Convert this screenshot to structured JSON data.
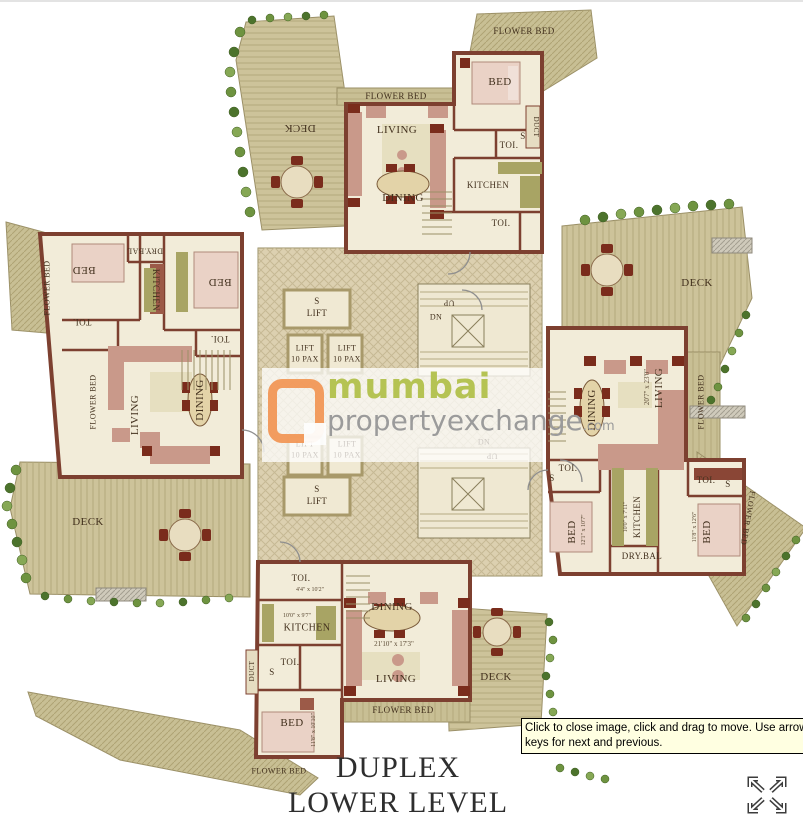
{
  "viewer": {
    "tooltip": "Click to close image, click and drag to move. Use arrow keys for next and previous.",
    "icons": {
      "move_icon": "expand-move-arrows",
      "logo_icon": "mumbai-propertyexchange-square"
    }
  },
  "title": {
    "line1": "DUPLEX",
    "line2": "LOWER LEVEL"
  },
  "watermark": {
    "brand": "mumbai",
    "brand2": "propertyexchange",
    "tld": ".com"
  },
  "colors": {
    "wall": "#7d4030",
    "floor": "#f2ecd9",
    "deck": "#cdc39a",
    "lobby": "#dcd0b0",
    "furniture": "#c9998a",
    "accent_dark": "#7a2c1c",
    "plants": "#6e9340",
    "watermark_orange": "#f29350",
    "watermark_green": "#b5c353",
    "watermark_gray": "#9b9b9b",
    "tooltip_bg": "#ffffe1"
  },
  "plan": {
    "labels": [
      {
        "t": "DECK",
        "x": 300,
        "y": 128,
        "r": 180,
        "s": 11
      },
      {
        "t": "FLOWER BED",
        "x": 524,
        "y": 31,
        "s": 9
      },
      {
        "t": "BED",
        "x": 500,
        "y": 82,
        "s": 11
      },
      {
        "t": "FLOWER BED",
        "x": 396,
        "y": 96,
        "s": 9
      },
      {
        "t": "LIVING",
        "x": 397,
        "y": 130,
        "s": 11
      },
      {
        "t": "TOI.",
        "x": 509,
        "y": 145,
        "s": 9
      },
      {
        "t": "S",
        "x": 523,
        "y": 136,
        "s": 9
      },
      {
        "t": "DUCT",
        "x": 536,
        "y": 127,
        "r": 90,
        "s": 7
      },
      {
        "t": "DINING",
        "x": 403,
        "y": 198,
        "s": 11
      },
      {
        "t": "KITCHEN",
        "x": 488,
        "y": 185,
        "s": 9
      },
      {
        "t": "TOI.",
        "x": 501,
        "y": 223,
        "s": 9
      },
      {
        "t": "FLOWER BED",
        "x": 47,
        "y": 288,
        "r": -90,
        "s": 8
      },
      {
        "t": "BED",
        "x": 84,
        "y": 270,
        "r": 180,
        "s": 11
      },
      {
        "t": "DRY.BAL",
        "x": 145,
        "y": 251,
        "r": 180,
        "s": 8
      },
      {
        "t": "KITCHEN",
        "x": 156,
        "y": 290,
        "r": 90,
        "s": 9
      },
      {
        "t": "BED",
        "x": 220,
        "y": 282,
        "r": 180,
        "s": 11
      },
      {
        "t": "TOI.",
        "x": 82,
        "y": 322,
        "r": 180,
        "s": 9
      },
      {
        "t": "TOI.",
        "x": 220,
        "y": 339,
        "r": 180,
        "s": 9
      },
      {
        "t": "FLOWER BED",
        "x": 93,
        "y": 402,
        "r": -90,
        "s": 8
      },
      {
        "t": "LIVING",
        "x": 135,
        "y": 415,
        "r": -90,
        "s": 11
      },
      {
        "t": "DINING",
        "x": 200,
        "y": 400,
        "r": -90,
        "s": 11
      },
      {
        "t": "DECK",
        "x": 88,
        "y": 522,
        "s": 11
      },
      {
        "t": "S",
        "x": 317,
        "y": 301,
        "s": 9
      },
      {
        "t": "LIFT",
        "x": 317,
        "y": 313,
        "s": 9
      },
      {
        "t": "LIFT",
        "x": 305,
        "y": 348,
        "s": 8
      },
      {
        "t": "10 PAX",
        "x": 305,
        "y": 359,
        "s": 8
      },
      {
        "t": "LIFT",
        "x": 347,
        "y": 348,
        "s": 8
      },
      {
        "t": "10 PAX",
        "x": 347,
        "y": 359,
        "s": 8
      },
      {
        "t": "DN",
        "x": 436,
        "y": 317,
        "s": 8
      },
      {
        "t": "UP",
        "x": 449,
        "y": 303,
        "r": 180,
        "s": 8
      },
      {
        "t": "LIFT",
        "x": 305,
        "y": 444,
        "s": 8
      },
      {
        "t": "10 PAX",
        "x": 305,
        "y": 455,
        "s": 8
      },
      {
        "t": "LIFT",
        "x": 347,
        "y": 444,
        "s": 8
      },
      {
        "t": "10 PAX",
        "x": 347,
        "y": 455,
        "s": 8
      },
      {
        "t": "DN",
        "x": 484,
        "y": 442,
        "s": 8
      },
      {
        "t": "UP",
        "x": 492,
        "y": 456,
        "r": 180,
        "s": 8
      },
      {
        "t": "S",
        "x": 317,
        "y": 489,
        "s": 9
      },
      {
        "t": "LIFT",
        "x": 317,
        "y": 501,
        "s": 9
      },
      {
        "t": "DECK",
        "x": 697,
        "y": 283,
        "s": 11
      },
      {
        "t": "DINING",
        "x": 592,
        "y": 410,
        "r": -90,
        "s": 11
      },
      {
        "t": "20'7\" x 23'0\"",
        "x": 647,
        "y": 387,
        "r": -90,
        "s": 7,
        "dim": true
      },
      {
        "t": "LIVING",
        "x": 659,
        "y": 388,
        "r": -90,
        "s": 11
      },
      {
        "t": "FLOWER BED",
        "x": 701,
        "y": 402,
        "r": -90,
        "s": 8
      },
      {
        "t": "TOI.",
        "x": 568,
        "y": 468,
        "s": 9
      },
      {
        "t": "S",
        "x": 552,
        "y": 478,
        "s": 9
      },
      {
        "t": "TOI.",
        "x": 706,
        "y": 480,
        "s": 9
      },
      {
        "t": "S",
        "x": 728,
        "y": 484,
        "s": 9
      },
      {
        "t": "10'0\" x 7'11\"",
        "x": 626,
        "y": 517,
        "r": -90,
        "s": 6,
        "dim": true
      },
      {
        "t": "KITCHEN",
        "x": 637,
        "y": 517,
        "r": -90,
        "s": 9
      },
      {
        "t": "DRY.BAL",
        "x": 642,
        "y": 556,
        "s": 9
      },
      {
        "t": "12'1\" x 10'7\"",
        "x": 584,
        "y": 530,
        "r": -90,
        "s": 6,
        "dim": true
      },
      {
        "t": "BED",
        "x": 572,
        "y": 532,
        "r": -90,
        "s": 11
      },
      {
        "t": "11'8\" x 12'6\"",
        "x": 695,
        "y": 527,
        "r": -90,
        "s": 6,
        "dim": true
      },
      {
        "t": "BED",
        "x": 707,
        "y": 532,
        "r": -90,
        "s": 11
      },
      {
        "t": "FLOWER BED",
        "x": 748,
        "y": 518,
        "r": 100,
        "s": 8
      },
      {
        "t": "TOI.",
        "x": 301,
        "y": 578,
        "s": 9
      },
      {
        "t": "4'4\" x 10'2\"",
        "x": 310,
        "y": 590,
        "s": 6,
        "dim": true
      },
      {
        "t": "10'0\" x 9'7\"",
        "x": 297,
        "y": 616,
        "s": 6,
        "dim": true
      },
      {
        "t": "KITCHEN",
        "x": 307,
        "y": 628,
        "s": 10
      },
      {
        "t": "DINING",
        "x": 392,
        "y": 607,
        "s": 11
      },
      {
        "t": "21'10\" x 17'3\"",
        "x": 394,
        "y": 644,
        "s": 7,
        "dim": true
      },
      {
        "t": "LIVING",
        "x": 396,
        "y": 679,
        "s": 11
      },
      {
        "t": "TOI.",
        "x": 290,
        "y": 662,
        "s": 9
      },
      {
        "t": "S",
        "x": 272,
        "y": 672,
        "s": 9
      },
      {
        "t": "DUCT",
        "x": 252,
        "y": 671,
        "r": -90,
        "s": 7
      },
      {
        "t": "BED",
        "x": 292,
        "y": 723,
        "s": 11
      },
      {
        "t": "11'8\" x 10'10\"",
        "x": 314,
        "y": 730,
        "r": -90,
        "s": 6,
        "dim": true
      },
      {
        "t": "FLOWER BED",
        "x": 403,
        "y": 710,
        "s": 9
      },
      {
        "t": "FLOWER BED",
        "x": 279,
        "y": 771,
        "s": 8
      },
      {
        "t": "DECK",
        "x": 496,
        "y": 677,
        "s": 11
      }
    ]
  }
}
